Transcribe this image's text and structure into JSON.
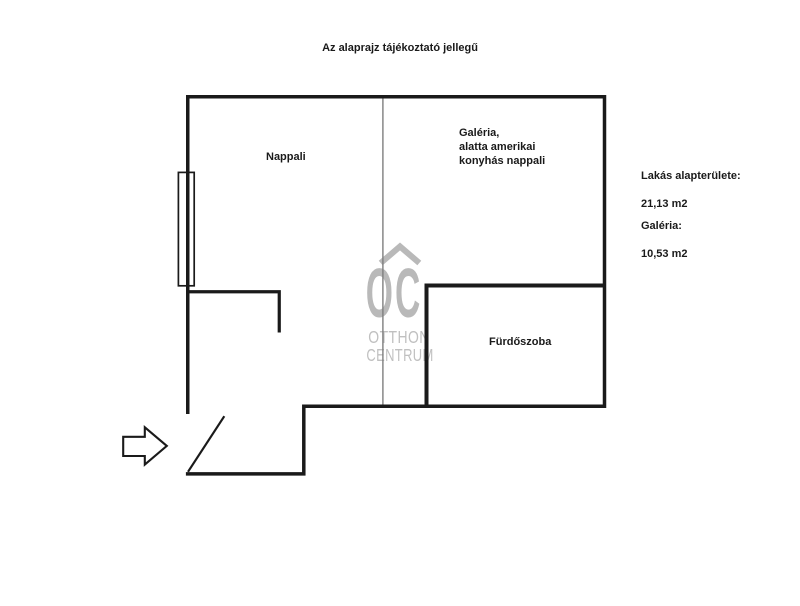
{
  "title": "Az alaprajz tájékoztató jellegű",
  "rooms": {
    "nappali": "Nappali",
    "galeria": "Galéria,\nalatta amerikai\nkonyhás nappali",
    "furdoszoba": "Fürdőszoba"
  },
  "info": {
    "apartment_area_label": "Lakás alapterülete:",
    "apartment_area_value": "21,13 m2",
    "galeria_area_label": "Galéria:",
    "galeria_area_value": "10,53 m2"
  },
  "watermark": {
    "monogram": "OC",
    "name_line1": "OTTHON",
    "name_line2": "CENTRUM"
  },
  "colors": {
    "wall": "#1a1a1a",
    "divider": "#7f7f7f",
    "watermark_logo": "#b9b9b9",
    "watermark_text": "#c0c0c0",
    "text": "#1a1a1a",
    "background": "#ffffff"
  }
}
